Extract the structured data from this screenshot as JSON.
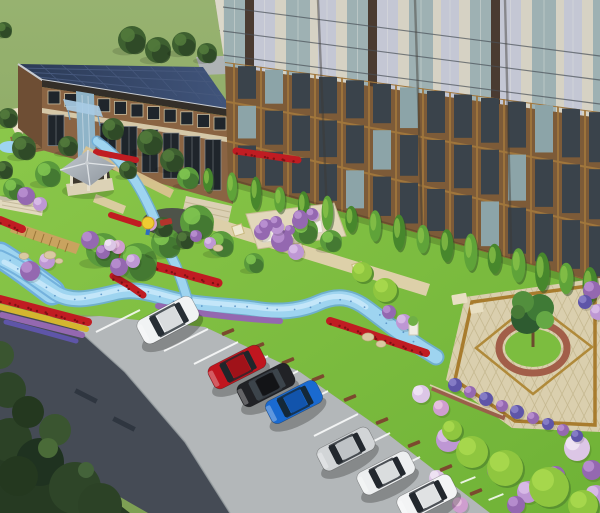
{
  "meta": {
    "title": "Aerial 3D rendering of residential community landscape design",
    "view": "bird's-eye perspective",
    "elements": [
      "grass field backdrop",
      "high-rise apartment tower",
      "two-storey clubhouse with solar panel roof",
      "service building",
      "gazebo",
      "vine pergola",
      "planting plot",
      "winding stream",
      "flower beds",
      "boardwalk",
      "central plaza with feature tree",
      "angled parking with cars",
      "asphalt lane",
      "dense corner trees"
    ]
  },
  "palette": {
    "field": "#8EAB66",
    "lawn": "#7CBD3F",
    "asphalt": "#454B55",
    "concrete": "#B3B7B9",
    "dark_trees": "#263A22",
    "stream": "#9ED4F0",
    "stream_core": "#C9E9FA",
    "stream_edge": "#6FAEDA",
    "red_flower": "#C01C22",
    "red_dark": "#7E1014",
    "yellow_flower": "#D4B62F",
    "purple": "#9468B0",
    "purple_light": "#BE97D4",
    "purple_white": "#DCC6E6",
    "purple_blue": "#5E55A8",
    "pink": "#CF9ECF",
    "plaza_cream": "#DACFAE",
    "plaza_grid": "#C6B992",
    "plaza_gold": "#A87C2E",
    "plaza_ring": "#A25E49",
    "boardwalk": "#C9A35F",
    "path_cream": "#E0D7BC",
    "path_tan": "#DDD0A9",
    "roof_navy": "#2B3A55",
    "roof_line": "#46587C",
    "roof_frame": "#C7CCD2",
    "brick_low": "#8A6443",
    "cream_trim": "#D5C8A8",
    "window_dark": "#1F252B",
    "canopy": "#A8CBE4",
    "glass_entry": "#8FB4C8",
    "tower_brick": "#7D5B38",
    "tower_gold": "#A0763C",
    "tower_cream": "#D6D2C4",
    "tower_glass": "#9EB1B3",
    "tower_glass_dark": "#3A434B",
    "tower_glass_lit": "#8CA4A8",
    "tower_lavender": "#C4C7D4",
    "tower_spandrel": "#4A3B31",
    "tower_line": "#4A5158",
    "gazebo_roof": "#B6BDC3",
    "gazebo_post": "#E6DFCC",
    "gazebo_floor": "#DCD2B6",
    "pergola_wood": "#8A6A42",
    "plot_soil": "#9A7349",
    "wall_brick": "#99604A",
    "bumper": "#7B4A2E",
    "stall_white": "#FFFFFF",
    "rock": "#D9C9A2",
    "cream_building": "#EDE3C9",
    "terrace": "#DBD0B4",
    "tree_shade": "#3E7030",
    "tree_mid": "#5A9A3C",
    "tree_light": "#7FC450",
    "slim_a": "#5FA339",
    "slim_b": "#47872C",
    "bush_green_hi": "#A8D84E",
    "bush_green": "#8FC63F",
    "bush_green_sh": "#5A9230",
    "umbrella": "#EFCB32",
    "bench_red": "#B2342C",
    "figure_blue": "#2E6CC0",
    "playground": "#4E5349",
    "gray_slab": "#AFB3B5"
  },
  "cars": [
    {
      "name": "white-suv",
      "label": "white SUV",
      "x": 168,
      "y": 320,
      "rot": -28,
      "l": 62,
      "w": 27,
      "body": "#F1F3F4",
      "roof": "#D9DCDE",
      "glass": "#272E35"
    },
    {
      "name": "red-sedan",
      "label": "red sedan",
      "x": 237,
      "y": 367,
      "rot": -27,
      "l": 58,
      "w": 25,
      "body": "#C0161F",
      "roof": "#A01219",
      "glass": "#20262B"
    },
    {
      "name": "black-sedan",
      "label": "black sedan",
      "x": 266,
      "y": 385,
      "rot": -27,
      "l": 58,
      "w": 25,
      "body": "#212226",
      "roof": "#131417",
      "glass": "#3C444B"
    },
    {
      "name": "blue-sedan",
      "label": "blue sedan",
      "x": 294,
      "y": 402,
      "rot": -27,
      "l": 57,
      "w": 25,
      "body": "#1A6AD0",
      "roof": "#1254AC",
      "glass": "#142838"
    },
    {
      "name": "silver-sedan",
      "label": "silver sedan",
      "x": 346,
      "y": 449,
      "rot": -27,
      "l": 58,
      "w": 25,
      "body": "#D2D5D7",
      "roof": "#BFC3C6",
      "glass": "#23282E"
    },
    {
      "name": "white-sedan",
      "label": "white sedan",
      "x": 386,
      "y": 473,
      "rot": -27,
      "l": 58,
      "w": 25,
      "body": "#EDEFF0",
      "roof": "#DADDDE",
      "glass": "#23282E"
    },
    {
      "name": "white-suv-2",
      "label": "white SUV",
      "x": 427,
      "y": 497,
      "rot": -27,
      "l": 60,
      "w": 26,
      "body": "#F3F4F5",
      "roof": "#E0E2E3",
      "glass": "#23282E"
    }
  ],
  "garden_trees": [
    [
      103,
      250,
      17,
      0
    ],
    [
      138,
      262,
      19,
      0
    ],
    [
      166,
      243,
      15,
      0
    ],
    [
      197,
      222,
      17,
      0
    ],
    [
      221,
      244,
      13,
      0
    ],
    [
      254,
      263,
      10,
      0
    ],
    [
      305,
      231,
      13,
      0
    ],
    [
      331,
      241,
      11,
      0
    ],
    [
      188,
      178,
      11,
      0
    ],
    [
      48,
      174,
      13,
      0
    ],
    [
      14,
      189,
      11,
      0
    ],
    [
      150,
      142,
      13,
      1
    ],
    [
      172,
      160,
      12,
      1
    ],
    [
      68,
      146,
      10,
      1
    ],
    [
      113,
      129,
      11,
      1
    ],
    [
      128,
      170,
      9,
      1
    ],
    [
      132,
      40,
      14,
      1
    ],
    [
      158,
      50,
      13,
      1
    ],
    [
      184,
      44,
      12,
      1
    ],
    [
      207,
      53,
      10,
      1
    ],
    [
      8,
      118,
      10,
      1
    ],
    [
      24,
      148,
      12,
      1
    ],
    [
      4,
      170,
      9,
      1
    ],
    [
      4,
      30,
      8,
      1
    ],
    [
      163,
      227,
      10,
      1
    ],
    [
      185,
      240,
      9,
      1
    ]
  ],
  "slim_trees": {
    "x1": 208,
    "y1": 180,
    "x2": 590,
    "y2": 285,
    "count": 17
  },
  "bushes": [
    [
      30,
      271,
      10,
      "p"
    ],
    [
      47,
      261,
      8,
      "l"
    ],
    [
      119,
      267,
      9,
      "p"
    ],
    [
      133,
      261,
      7,
      "l"
    ],
    [
      26,
      196,
      9,
      "p"
    ],
    [
      40,
      204,
      7,
      "l"
    ],
    [
      90,
      240,
      9,
      "p"
    ],
    [
      103,
      252,
      7,
      "p"
    ],
    [
      282,
      241,
      11,
      "p"
    ],
    [
      296,
      252,
      8,
      "l"
    ],
    [
      262,
      232,
      8,
      "p"
    ],
    [
      277,
      227,
      7,
      "l"
    ],
    [
      300,
      221,
      8,
      "p"
    ],
    [
      313,
      215,
      6,
      "l"
    ],
    [
      150,
      224,
      7,
      "k"
    ],
    [
      118,
      247,
      7,
      "k"
    ],
    [
      196,
      236,
      6,
      "p"
    ],
    [
      210,
      243,
      6,
      "l"
    ],
    [
      448,
      440,
      12,
      "l"
    ],
    [
      467,
      452,
      9,
      "p"
    ],
    [
      497,
      470,
      10,
      "p"
    ],
    [
      528,
      492,
      11,
      "l"
    ],
    [
      556,
      475,
      9,
      "p"
    ],
    [
      577,
      448,
      13,
      "w"
    ],
    [
      592,
      470,
      10,
      "p"
    ],
    [
      596,
      496,
      11,
      "l"
    ],
    [
      437,
      478,
      8,
      "w"
    ],
    [
      516,
      505,
      9,
      "p"
    ],
    [
      460,
      505,
      8,
      "k"
    ],
    [
      455,
      385,
      7,
      "b"
    ],
    [
      470,
      392,
      6,
      "p"
    ],
    [
      486,
      399,
      7,
      "b"
    ],
    [
      502,
      406,
      6,
      "p"
    ],
    [
      517,
      412,
      7,
      "b"
    ],
    [
      533,
      418,
      6,
      "p"
    ],
    [
      548,
      424,
      6,
      "b"
    ],
    [
      563,
      430,
      6,
      "p"
    ],
    [
      577,
      436,
      6,
      "b"
    ],
    [
      421,
      394,
      9,
      "w"
    ],
    [
      441,
      408,
      8,
      "k"
    ],
    [
      404,
      322,
      8,
      "l"
    ],
    [
      389,
      312,
      7,
      "p"
    ],
    [
      592,
      290,
      9,
      "p"
    ],
    [
      598,
      312,
      8,
      "l"
    ],
    [
      585,
      302,
      7,
      "b"
    ],
    [
      110,
      245,
      6,
      "w"
    ]
  ],
  "green_bushes": [
    [
      472,
      452,
      16
    ],
    [
      505,
      468,
      18
    ],
    [
      549,
      487,
      20
    ],
    [
      583,
      505,
      15
    ],
    [
      452,
      430,
      10
    ],
    [
      385,
      290,
      12
    ],
    [
      362,
      272,
      10
    ]
  ],
  "red_beds": [
    {
      "d": "M0,220 L22,229",
      "w": 8,
      "c": "red_flower",
      "dots": true
    },
    {
      "d": "M96,152 L136,160",
      "w": 6,
      "c": "red_flower",
      "dots": false
    },
    {
      "d": "M236,151 L298,160",
      "w": 7,
      "c": "red_flower",
      "dots": true
    },
    {
      "d": "M111,215 L139,224",
      "w": 6,
      "c": "red_flower",
      "dots": false
    },
    {
      "d": "M113,276 L130,286 L143,295",
      "w": 7,
      "c": "red_flower",
      "dots": true
    },
    {
      "d": "M110,255 C140,262 168,269 196,277 L218,283",
      "w": 9,
      "c": "red_flower",
      "dots": true
    },
    {
      "d": "M330,321 C356,329 384,339 408,347 L426,353",
      "w": 8,
      "c": "red_flower",
      "dots": true
    },
    {
      "d": "M0,299 L46,311 L88,322",
      "w": 8,
      "c": "red_flower",
      "dots": true
    },
    {
      "d": "M0,307 L44,318 L86,329",
      "w": 6,
      "c": "yellow_flower",
      "dots": false
    },
    {
      "d": "M2,315 L42,325 L82,335",
      "w": 6,
      "c": "purple",
      "dots": false
    },
    {
      "d": "M6,322 L40,331 L76,341",
      "w": 5,
      "c": "purple_blue",
      "dots": false
    },
    {
      "d": "M158,306 C200,314 240,319 280,321",
      "w": 6,
      "c": "purple",
      "dots": false
    }
  ],
  "stall_lines": [
    [
      140,
      310
    ],
    [
      208,
      329
    ],
    [
      238,
      342
    ],
    [
      268,
      356
    ],
    [
      298,
      371
    ],
    [
      328,
      391
    ],
    [
      358,
      414
    ],
    [
      390,
      433
    ],
    [
      420,
      457
    ],
    [
      452,
      483
    ]
  ],
  "bumpers": [
    [
      160,
      312
    ],
    [
      228,
      332
    ],
    [
      258,
      346
    ],
    [
      288,
      361
    ],
    [
      318,
      378
    ],
    [
      350,
      398
    ],
    [
      382,
      421
    ],
    [
      414,
      444
    ],
    [
      446,
      468
    ],
    [
      476,
      492
    ]
  ],
  "lawn_dashes": [
    [
      468,
      480
    ],
    [
      496,
      497
    ]
  ],
  "speed_bumps": [
    [
      86,
      396
    ],
    [
      124,
      424
    ]
  ],
  "boulders": [
    [
      24,
      256,
      5
    ],
    [
      50,
      255,
      6
    ],
    [
      59,
      261,
      4
    ],
    [
      218,
      248,
      5
    ],
    [
      368,
      337,
      6
    ],
    [
      381,
      344,
      5
    ]
  ]
}
